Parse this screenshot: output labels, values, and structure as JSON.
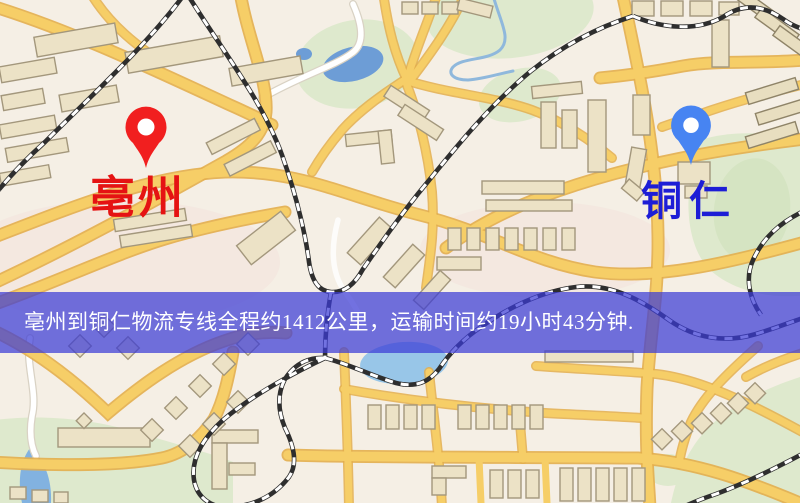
{
  "banner": {
    "text": "亳州到铜仁物流专线全程约1412公里，运输时间约19小时43分钟."
  },
  "markers": {
    "origin": {
      "label": "亳州",
      "pin_color": "#f11f1f",
      "label_color": "#e51313"
    },
    "destination": {
      "label": "铜仁",
      "pin_color": "#4784f2",
      "label_color": "#1d1dd6"
    }
  },
  "colors": {
    "banner_bg": "rgba(59,59,214,0.72)",
    "banner_text": "#ffffff",
    "road_major": "#f6ce67",
    "road_casing": "#e3ae4c",
    "water": "#6d9dd6",
    "park": "#dee9cd",
    "building": "#ece2c6",
    "railway": "#2e2e2e",
    "background": "#f5efe5"
  }
}
